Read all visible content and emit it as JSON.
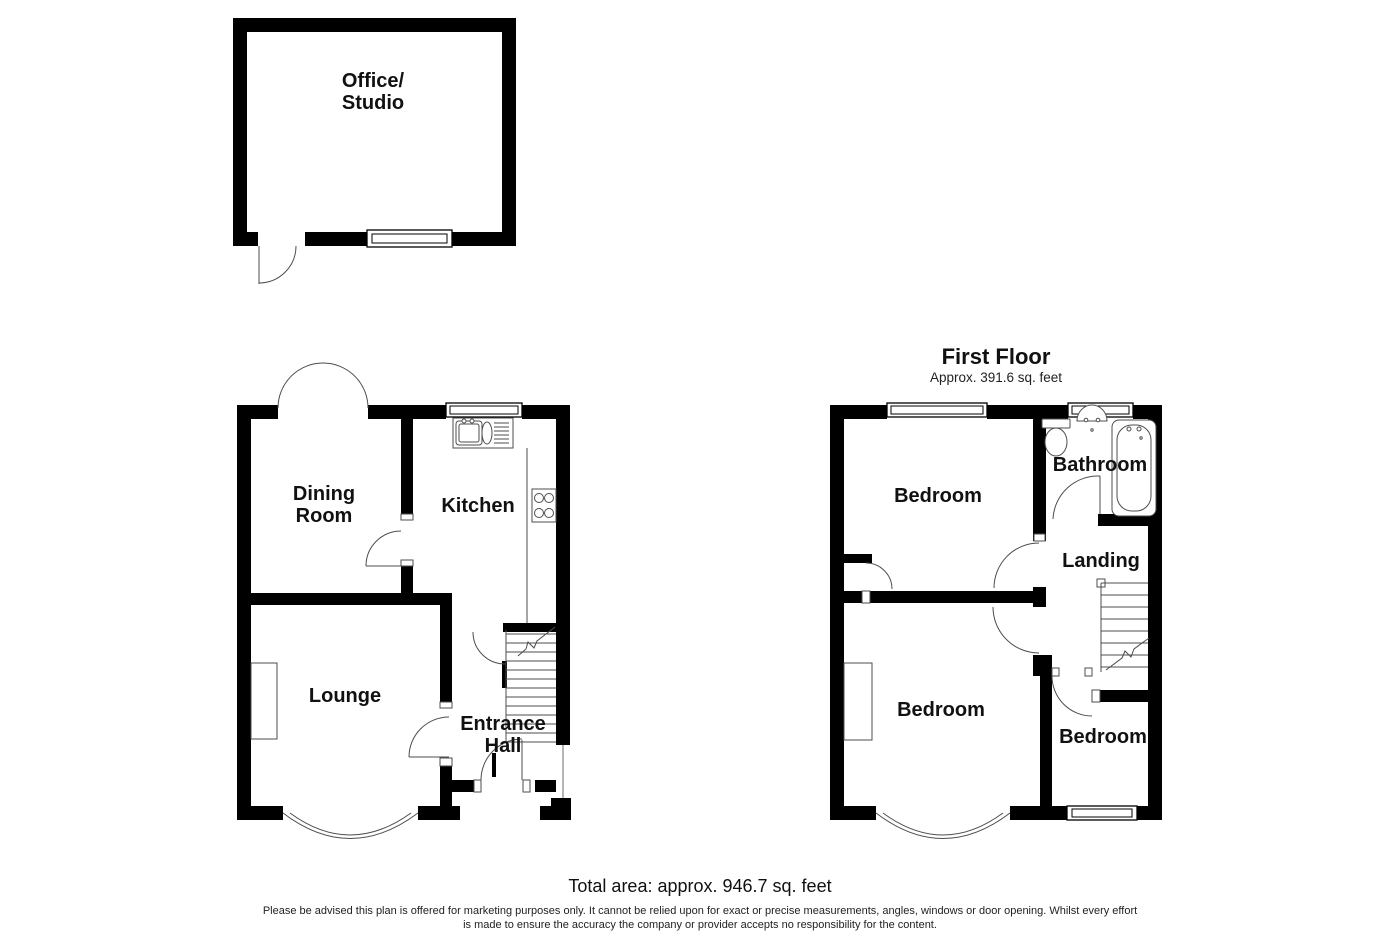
{
  "colors": {
    "background": "#ffffff",
    "walls": "#000000",
    "thin_lines": "#4d4d4d",
    "text": "#111111"
  },
  "office_studio": {
    "label_line1": "Office/",
    "label_line2": "Studio"
  },
  "ground_floor": {
    "dining_room_line1": "Dining",
    "dining_room_line2": "Room",
    "kitchen": "Kitchen",
    "lounge": "Lounge",
    "entrance_hall_line1": "Entrance",
    "entrance_hall_line2": "Hall"
  },
  "first_floor": {
    "title": "First Floor",
    "area": "Approx. 391.6 sq. feet",
    "bedroom_front": "Bedroom",
    "bathroom": "Bathroom",
    "landing": "Landing",
    "bedroom_rear": "Bedroom",
    "bedroom_small": "Bedroom"
  },
  "footer": {
    "total_area": "Total area: approx. 946.7 sq. feet",
    "disclaimer_line1": "Please be advised this plan is offered for marketing purposes only. It cannot be relied upon for exact or precise measurements, angles, windows or door opening. Whilst every effort",
    "disclaimer_line2": "is made to ensure the accuracy the company or provider accepts no responsibility for the content."
  }
}
